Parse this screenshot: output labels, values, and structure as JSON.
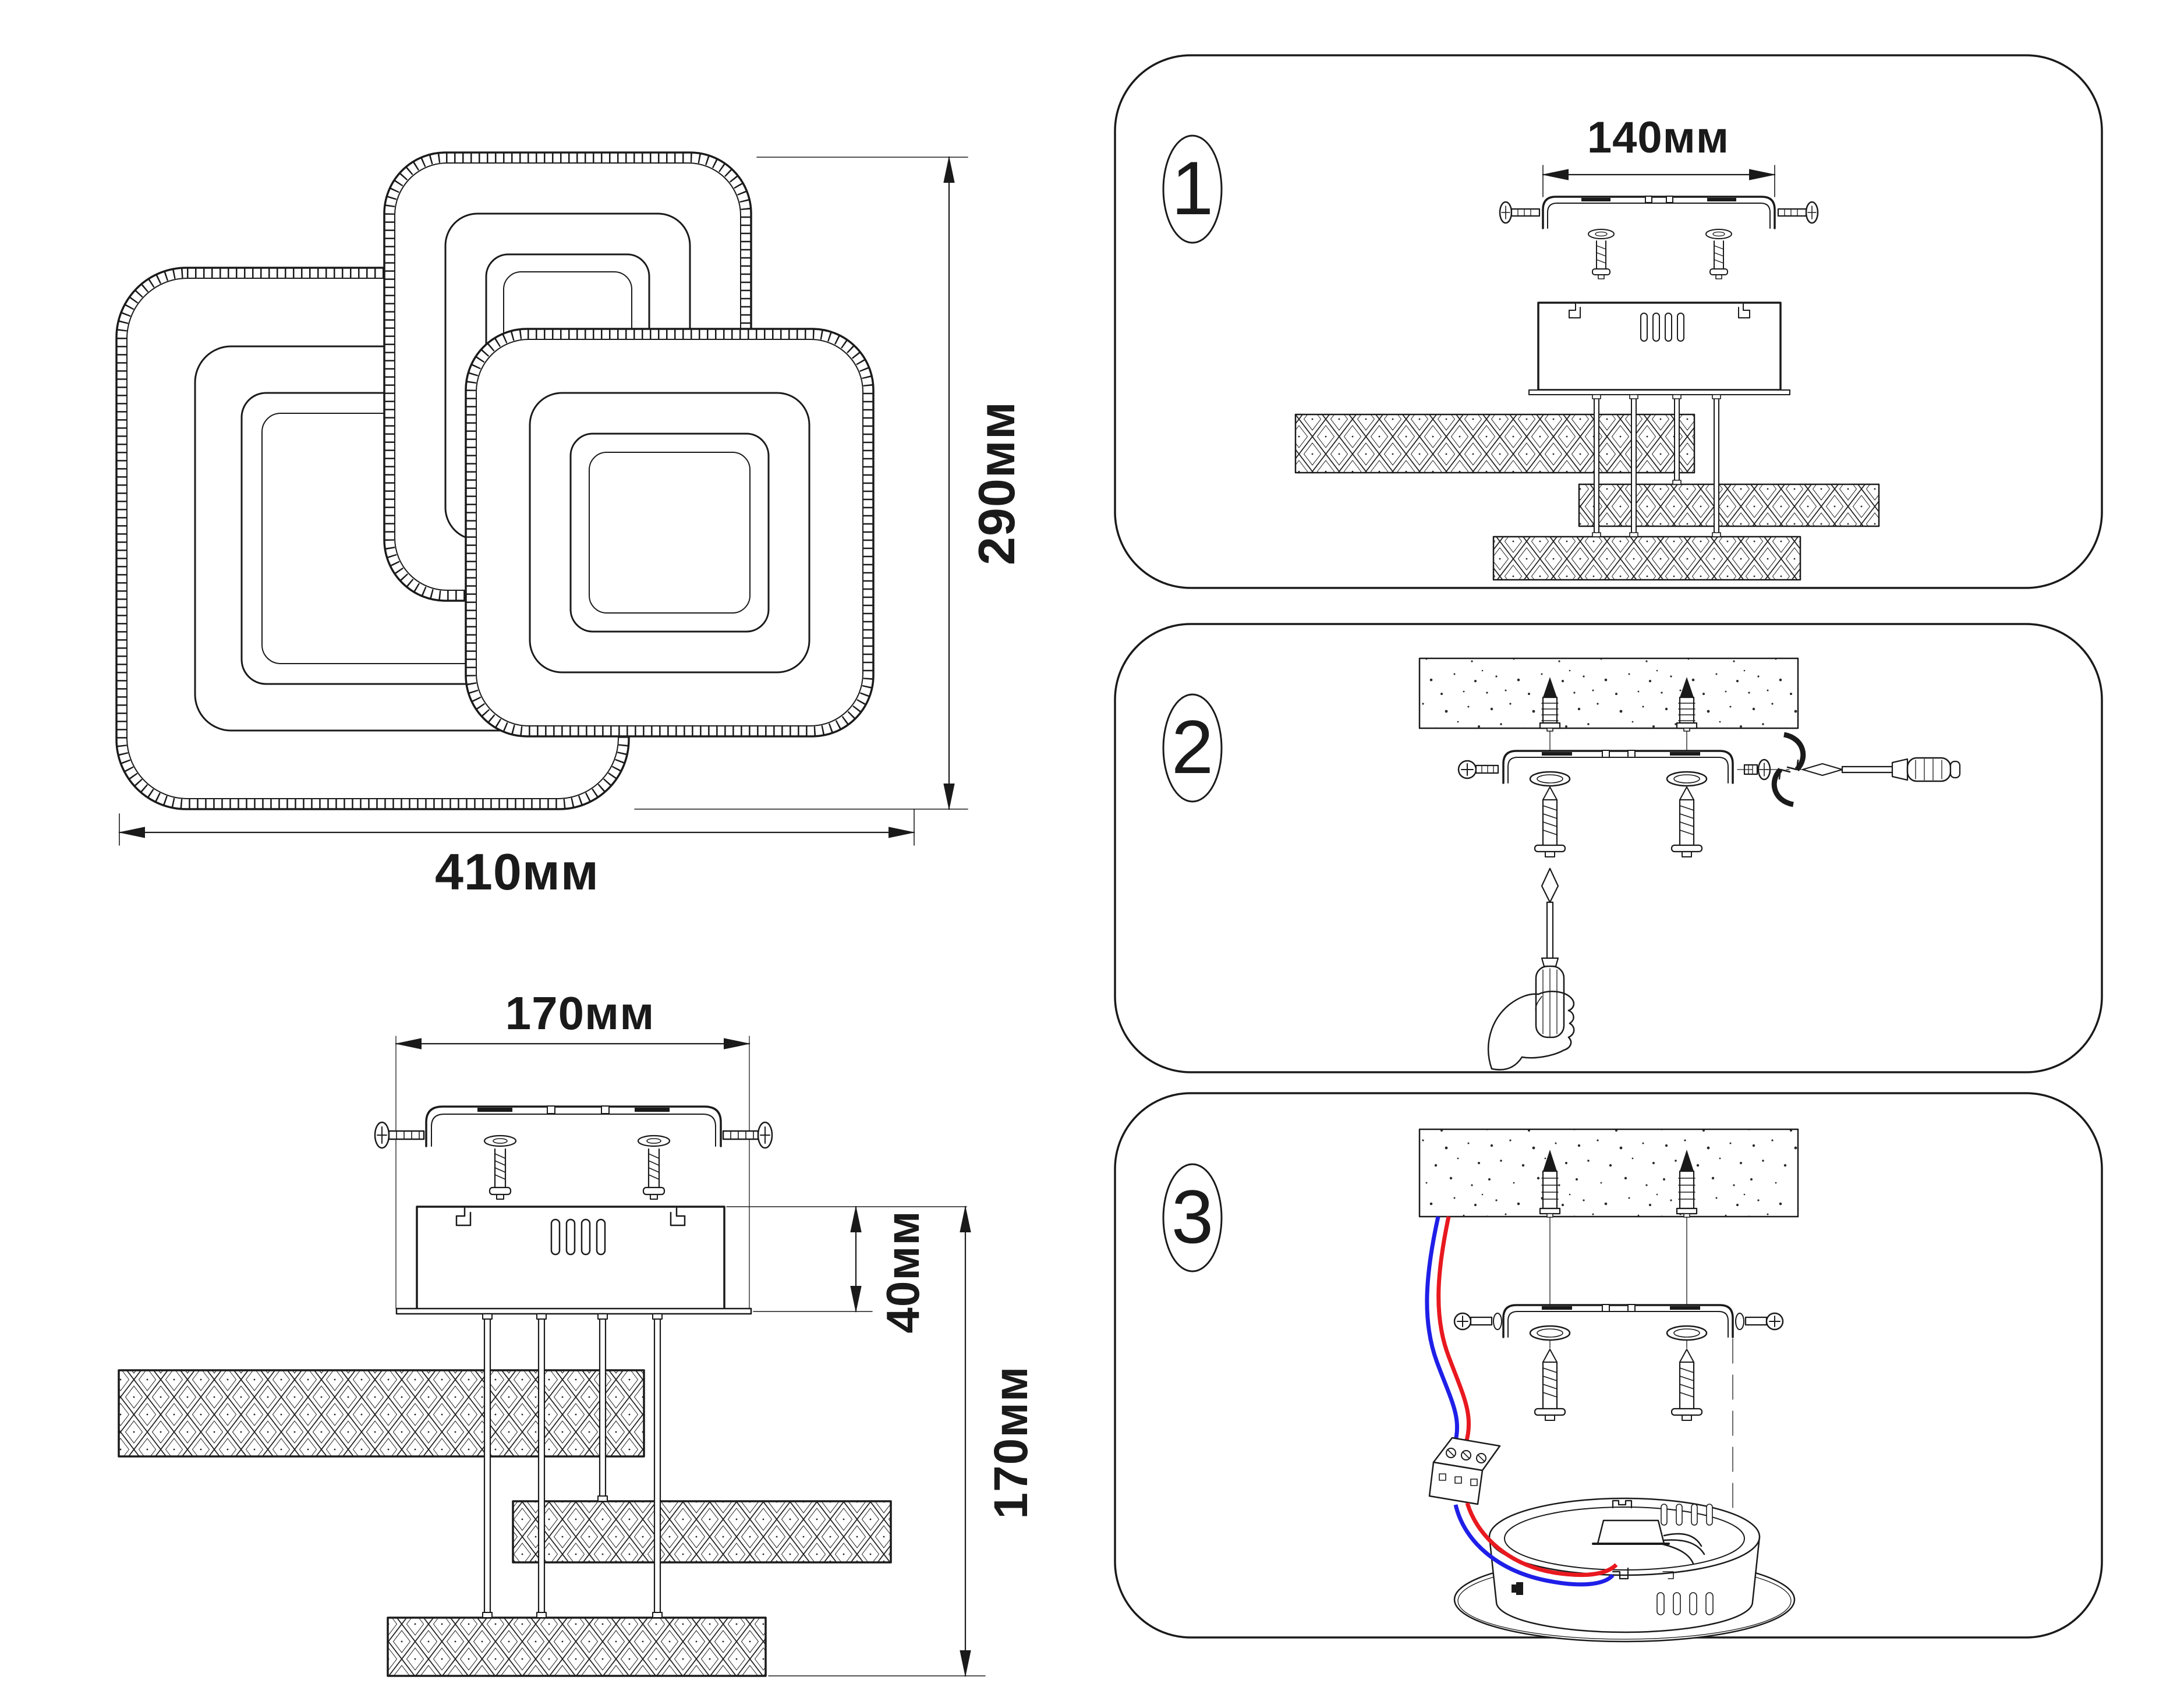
{
  "page": {
    "background": "#ffffff",
    "ink_color": "#1a1a1a"
  },
  "top_view": {
    "width_label": "410мм",
    "height_label": "290мм"
  },
  "side_view": {
    "bracket_width_label": "170мм",
    "driver_height_label": "40мм",
    "total_height_label": "170мм"
  },
  "panels": [
    {
      "number": "1",
      "dimension_label": "140мм"
    },
    {
      "number": "2"
    },
    {
      "number": "3"
    }
  ],
  "wires": {
    "live_color": "#e8191f",
    "neutral_color": "#1f1fe8"
  },
  "icons": [
    "crystal-square-frame",
    "crystal-bar",
    "mounting-bracket",
    "driver-box",
    "screw",
    "washer",
    "wall-plug",
    "ceiling-slab",
    "screwdriver",
    "hand",
    "rotation-arrows",
    "terminal-block",
    "canopy-base",
    "wire-clamp"
  ]
}
